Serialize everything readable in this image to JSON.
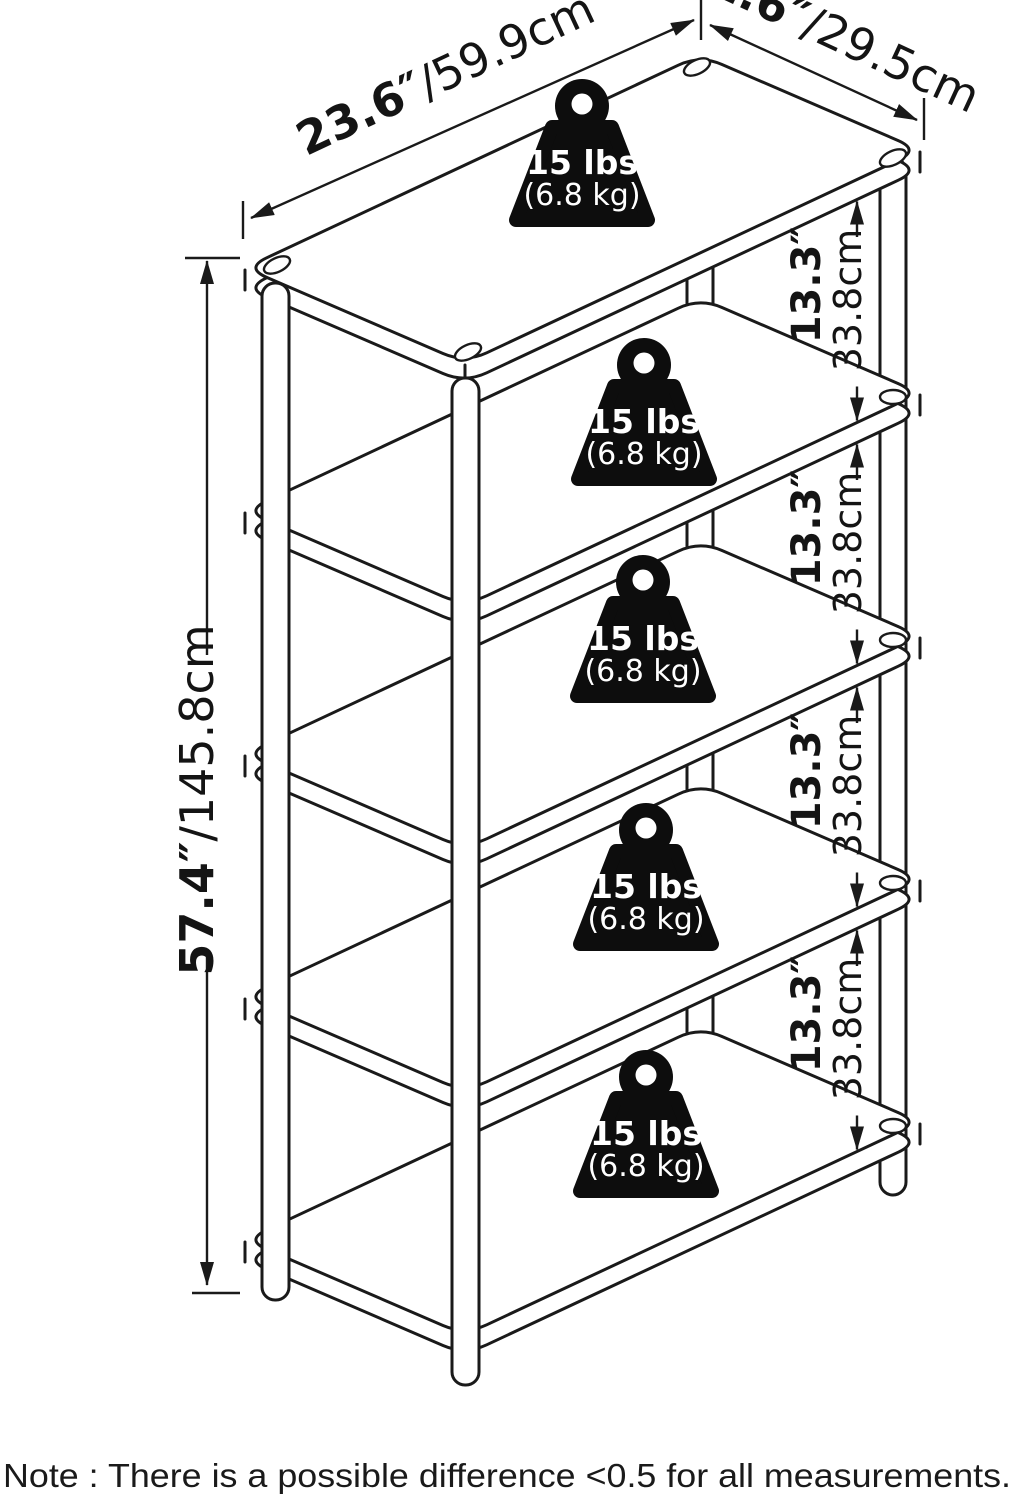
{
  "dims": {
    "width": {
      "in": "23.6″",
      "cm": "/59.9cm"
    },
    "depth": {
      "in": "11.6″",
      "cm": "/29.5cm"
    },
    "height": {
      "in": "57.4″",
      "cm": "/145.8cm"
    },
    "spacing": {
      "in": "13.3″",
      "cm": "33.8cm"
    }
  },
  "weight": {
    "lbs": "15 lbs",
    "kg": "(6.8 kg)"
  },
  "note": {
    "text": "Note : There is a possible difference <0.5 for all measurements."
  },
  "colors": {
    "line": "#1a1a1a",
    "background": "#ffffff"
  }
}
